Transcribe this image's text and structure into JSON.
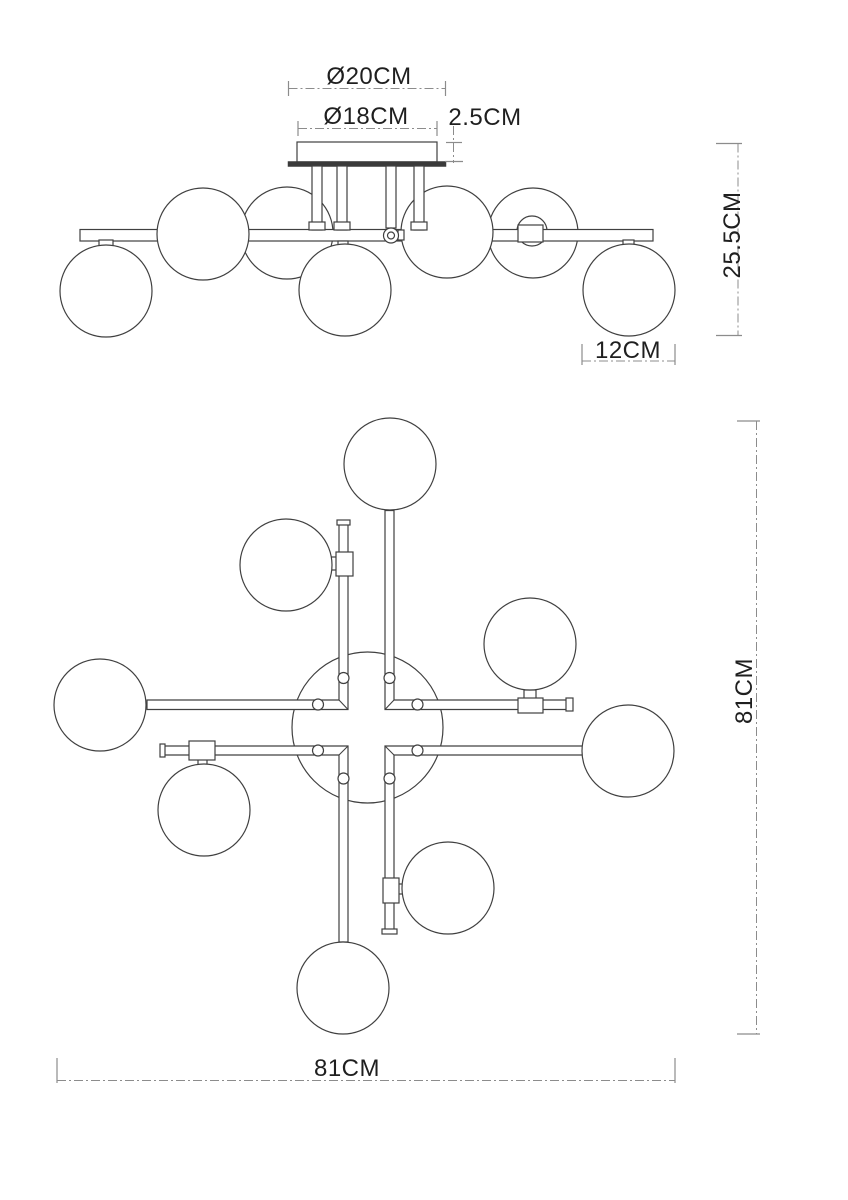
{
  "drawing": {
    "type": "lighting-fixture-technical-drawing",
    "views": {
      "top": "side-elevation",
      "bottom": "plan-view"
    }
  },
  "dimensions": {
    "canopy_outer": "Ø20CM",
    "canopy_inner": "Ø18CM",
    "canopy_height": "2.5CM",
    "overall_drop": "25.5CM",
    "globe_diameter": "12CM",
    "overall_depth": "81CM",
    "overall_width": "81CM"
  },
  "colors": {
    "line": "#404040",
    "dimension_line": "#8c8c8c",
    "text": "#1f1f1f",
    "background": "#ffffff"
  }
}
